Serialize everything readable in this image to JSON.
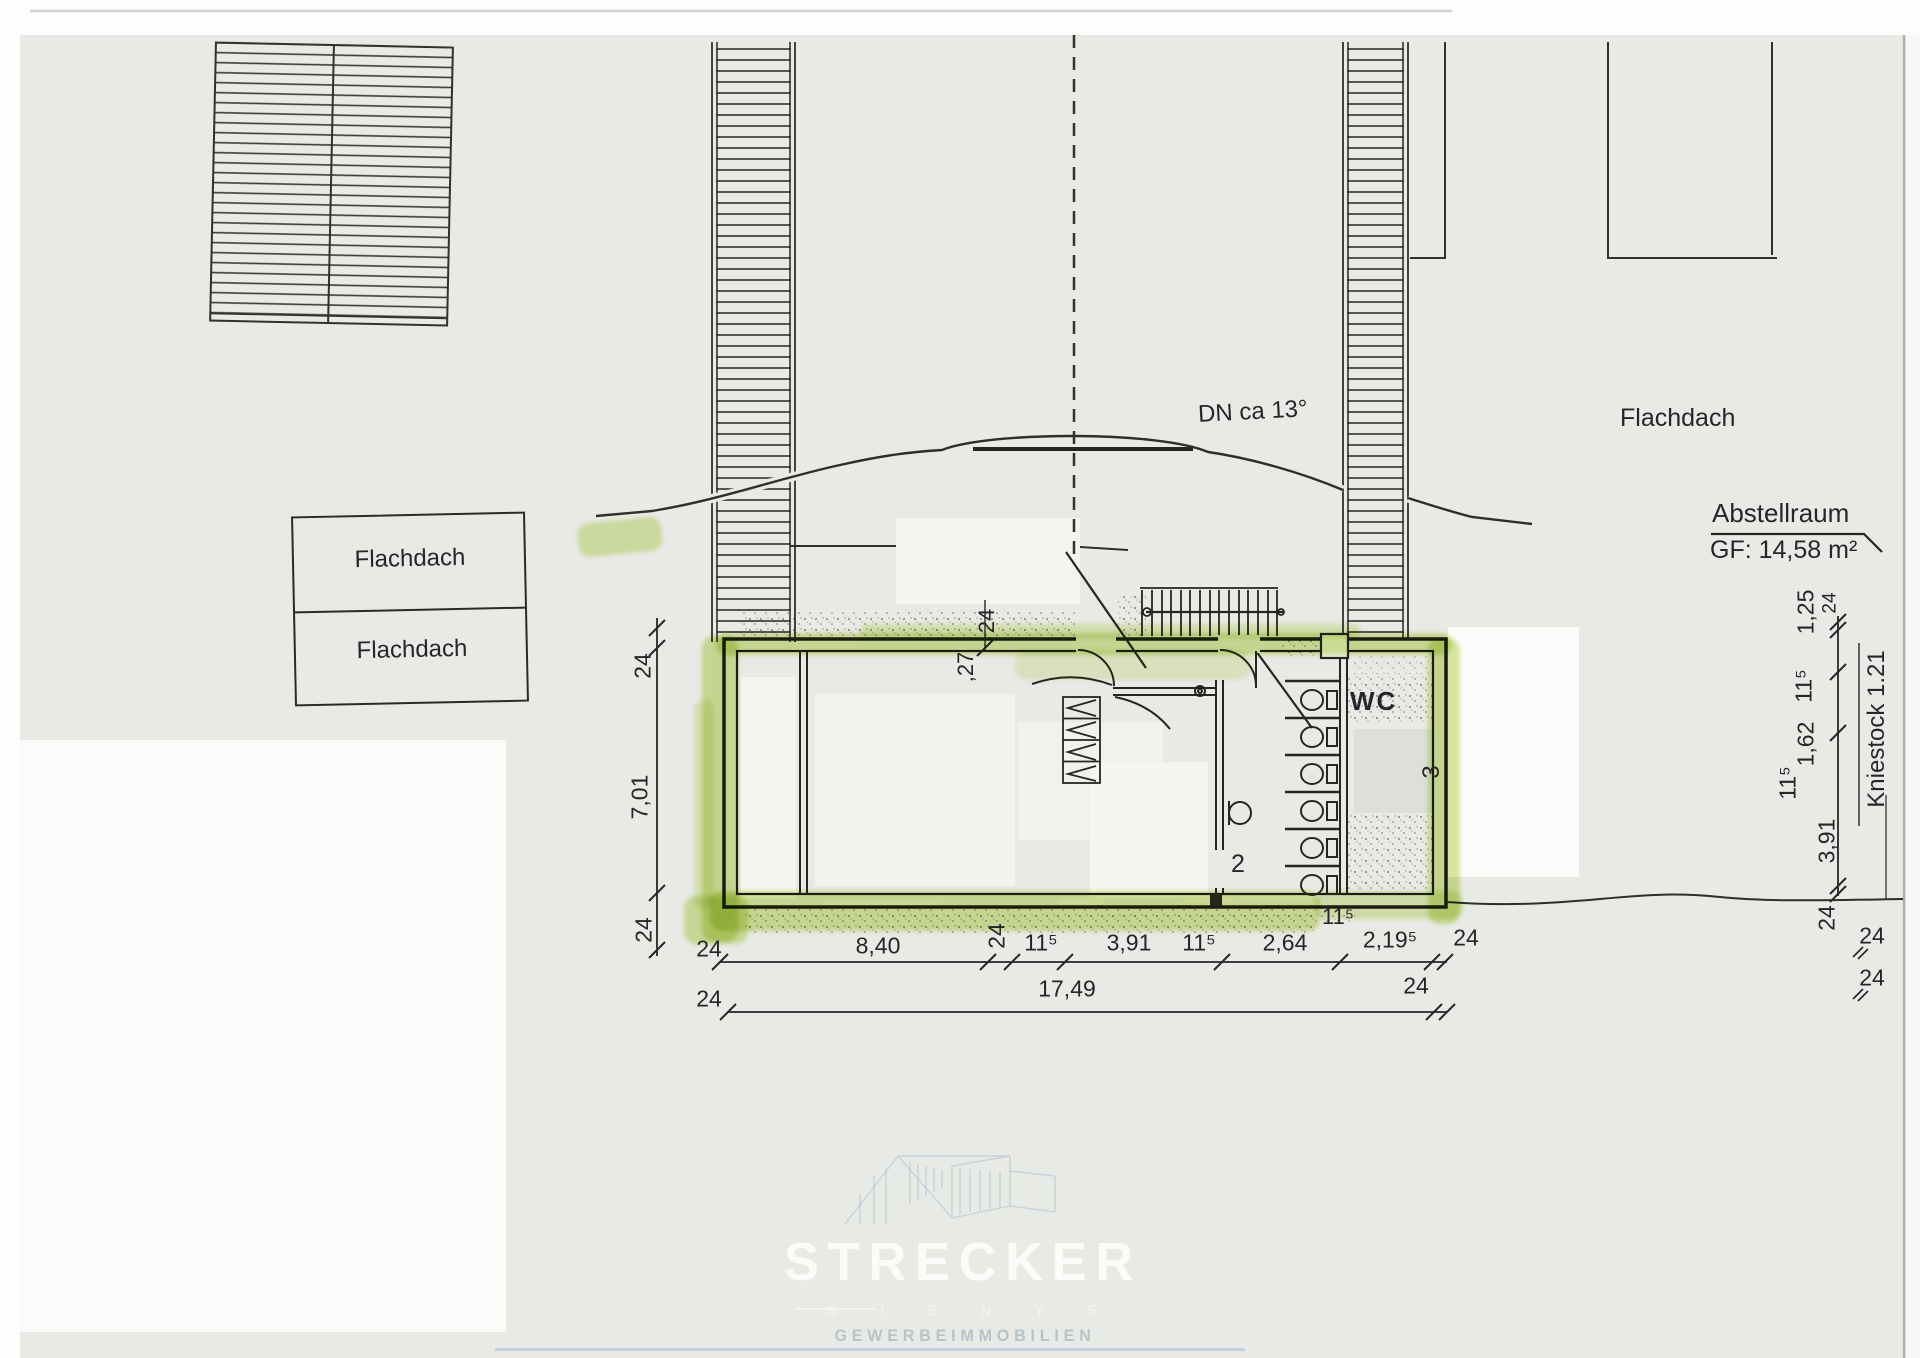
{
  "labels": {
    "flachdach_box_row1": "Flachdach",
    "flachdach_box_row2": "Flachdach",
    "flachdach_right": "Flachdach",
    "roof_pitch": "DN ca 13°",
    "abstellraum_title": "Abstellraum",
    "abstellraum_area": "GF: 14,58 m²",
    "wc": "WC",
    "kniestock": "Kniestock 1.21",
    "door_number_2": "2",
    "room_number_3": "3"
  },
  "dims": {
    "left": {
      "top": "24",
      "middle": "7,01",
      "bottom": "24"
    },
    "top_inner": {
      "wall": "24",
      "niche": ",27"
    },
    "bottom_row1": [
      "24",
      "8,40",
      "24",
      "11⁵",
      "3,91",
      "11⁵",
      "2,64",
      "2,19⁵",
      "24"
    ],
    "bottom_row2": [
      "24",
      "17,49",
      "24"
    ],
    "under_wall": "11⁵",
    "right_chain": [
      "1,25",
      "24",
      "11⁵",
      "1,62",
      "11⁵",
      "3,91",
      "24"
    ],
    "right_edge": [
      "24",
      "24"
    ]
  },
  "watermark": {
    "title": "STRECKER",
    "tagline": "S I E N Y S",
    "subtitle": "GEWERBEIMMOBILIEN"
  },
  "colors": {
    "highlighter": "#b9d44e",
    "paper": "#e8eae5",
    "ink": "#26261f",
    "watermark_blue": "#9fb4c4"
  }
}
